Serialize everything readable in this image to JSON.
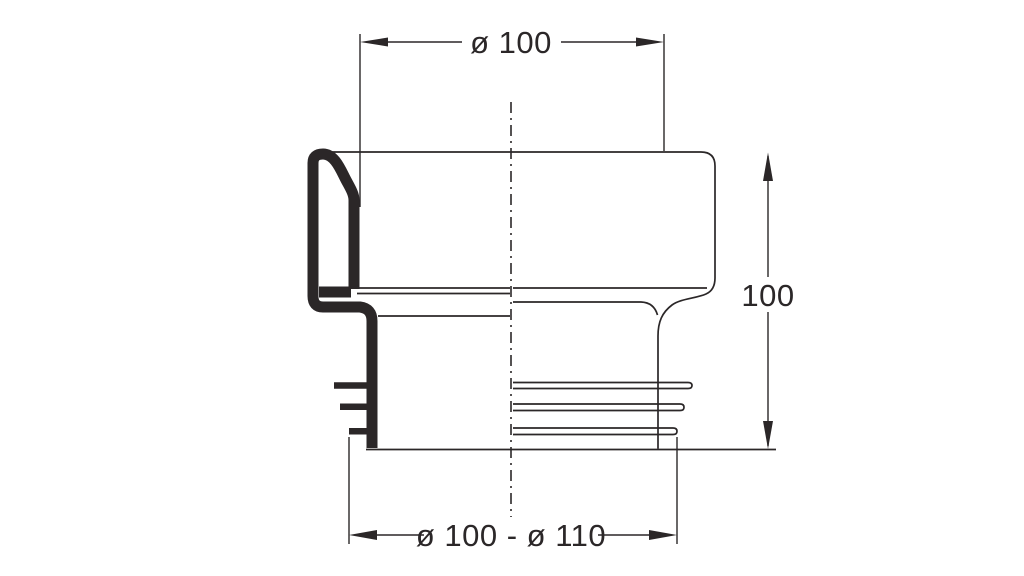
{
  "drawing": {
    "kind": "technical dimension drawing, half-section",
    "line_color": "#2b2728",
    "background_color": "#ffffff",
    "dimensions": {
      "top_diameter": {
        "label": "ø 100"
      },
      "overall_height": {
        "label": "100"
      },
      "bottom_diameter": {
        "label": "ø 100 - ø 110"
      }
    }
  }
}
